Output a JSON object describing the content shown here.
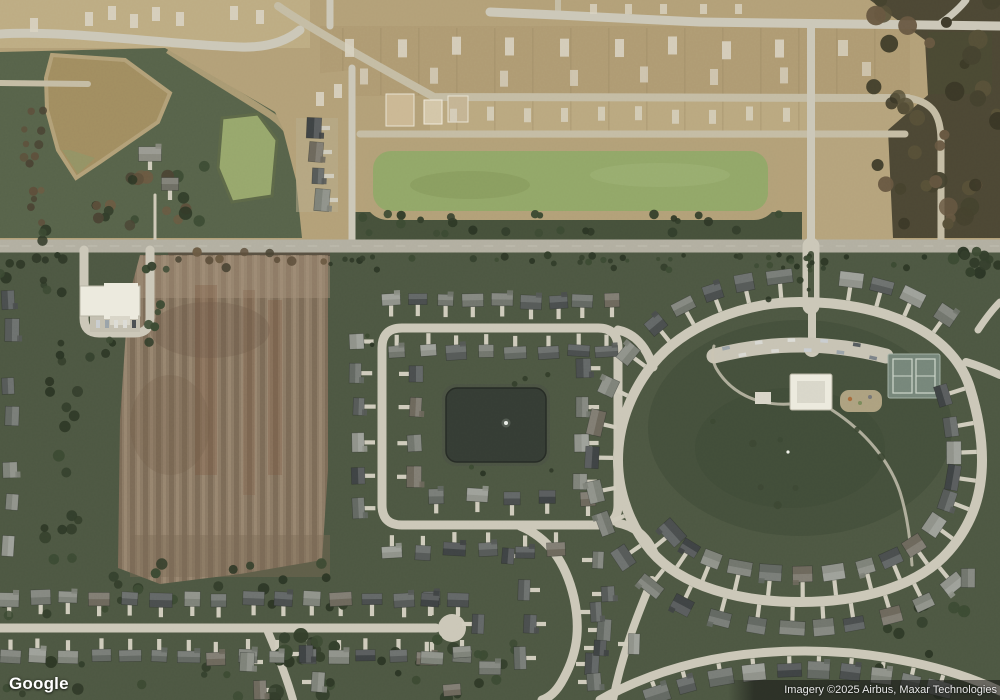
{
  "map": {
    "view_type": "satellite-imagery",
    "watermark": "Google",
    "attribution": "Imagery ©2025 Airbus, Maxar Technologies"
  },
  "palette": {
    "grass": "#4d5742",
    "grass_light": "#57634a",
    "grass_dark": "#3f4936",
    "park": "#45503c",
    "veg_strip": "#46513b",
    "road": "#cbc7b8",
    "road_main": "#b2afa1",
    "road_dirt": "#c4bca4",
    "drive": "#cfcbbc",
    "construction": "#b3a078",
    "construction_light": "#c2b088",
    "pad": "#d8d2c1",
    "field": "#8b7a65",
    "field_light": "#a3907a",
    "field_dark": "#6e5b49",
    "field_rust": "#7c5640",
    "pond_brown": "#a18d60",
    "pond_green": "#92a768",
    "pond_green_small": "#97a76c",
    "pond_dark": "#353c34",
    "pond_bank": "#b2a078",
    "woods_base": "#4c4734",
    "white_building": "#eceade",
    "court": "#76867a",
    "court_line": "#cdd6ca",
    "playground": "#b3a584",
    "roof_colors": [
      "#3f4344",
      "#4a4e4e",
      "#565a58",
      "#636862",
      "#71756d",
      "#7e8279",
      "#8f928a",
      "#6d685c"
    ]
  }
}
